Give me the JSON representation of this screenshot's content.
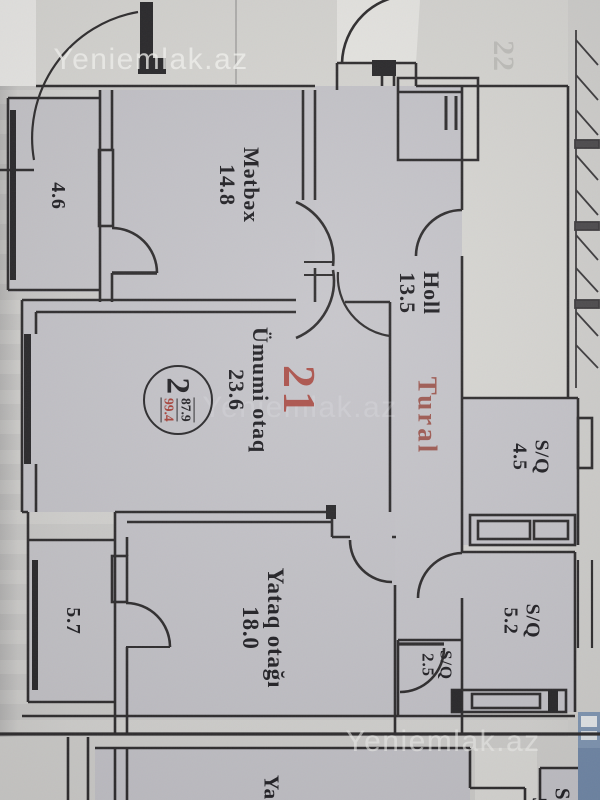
{
  "photo": {
    "watermark_text": "Yeniemlak.az"
  },
  "listing": {
    "apartment_number": "21",
    "agent_name": "Tural",
    "stamp": {
      "room_count": "2",
      "total_area": "99.4",
      "living_area": "87.9"
    },
    "neighbor_apartment_number": "22"
  },
  "rooms": {
    "kitchen": {
      "name": "Mətbəx",
      "area": "14.8"
    },
    "hall": {
      "name": "Holl",
      "area": "13.5"
    },
    "living_room": {
      "name": "Ümumi otaq",
      "area": "23.6"
    },
    "bedroom": {
      "name": "Yataq otağı",
      "area": "18.0"
    },
    "bathroom_1": {
      "name": "S/Q",
      "area": "4.5"
    },
    "bathroom_2": {
      "name": "S/Q",
      "area": "5.2"
    },
    "bathroom_3": {
      "name": "S/Q",
      "area": "2.5"
    },
    "balcony_top": {
      "area": "4.6"
    },
    "balcony_bottom": {
      "area": "5.7"
    }
  },
  "adjacent_unit": {
    "bedroom_label_partial": "Yata",
    "bathroom_label_partial": "S/Q",
    "bathroom_area_partial": "5."
  }
}
